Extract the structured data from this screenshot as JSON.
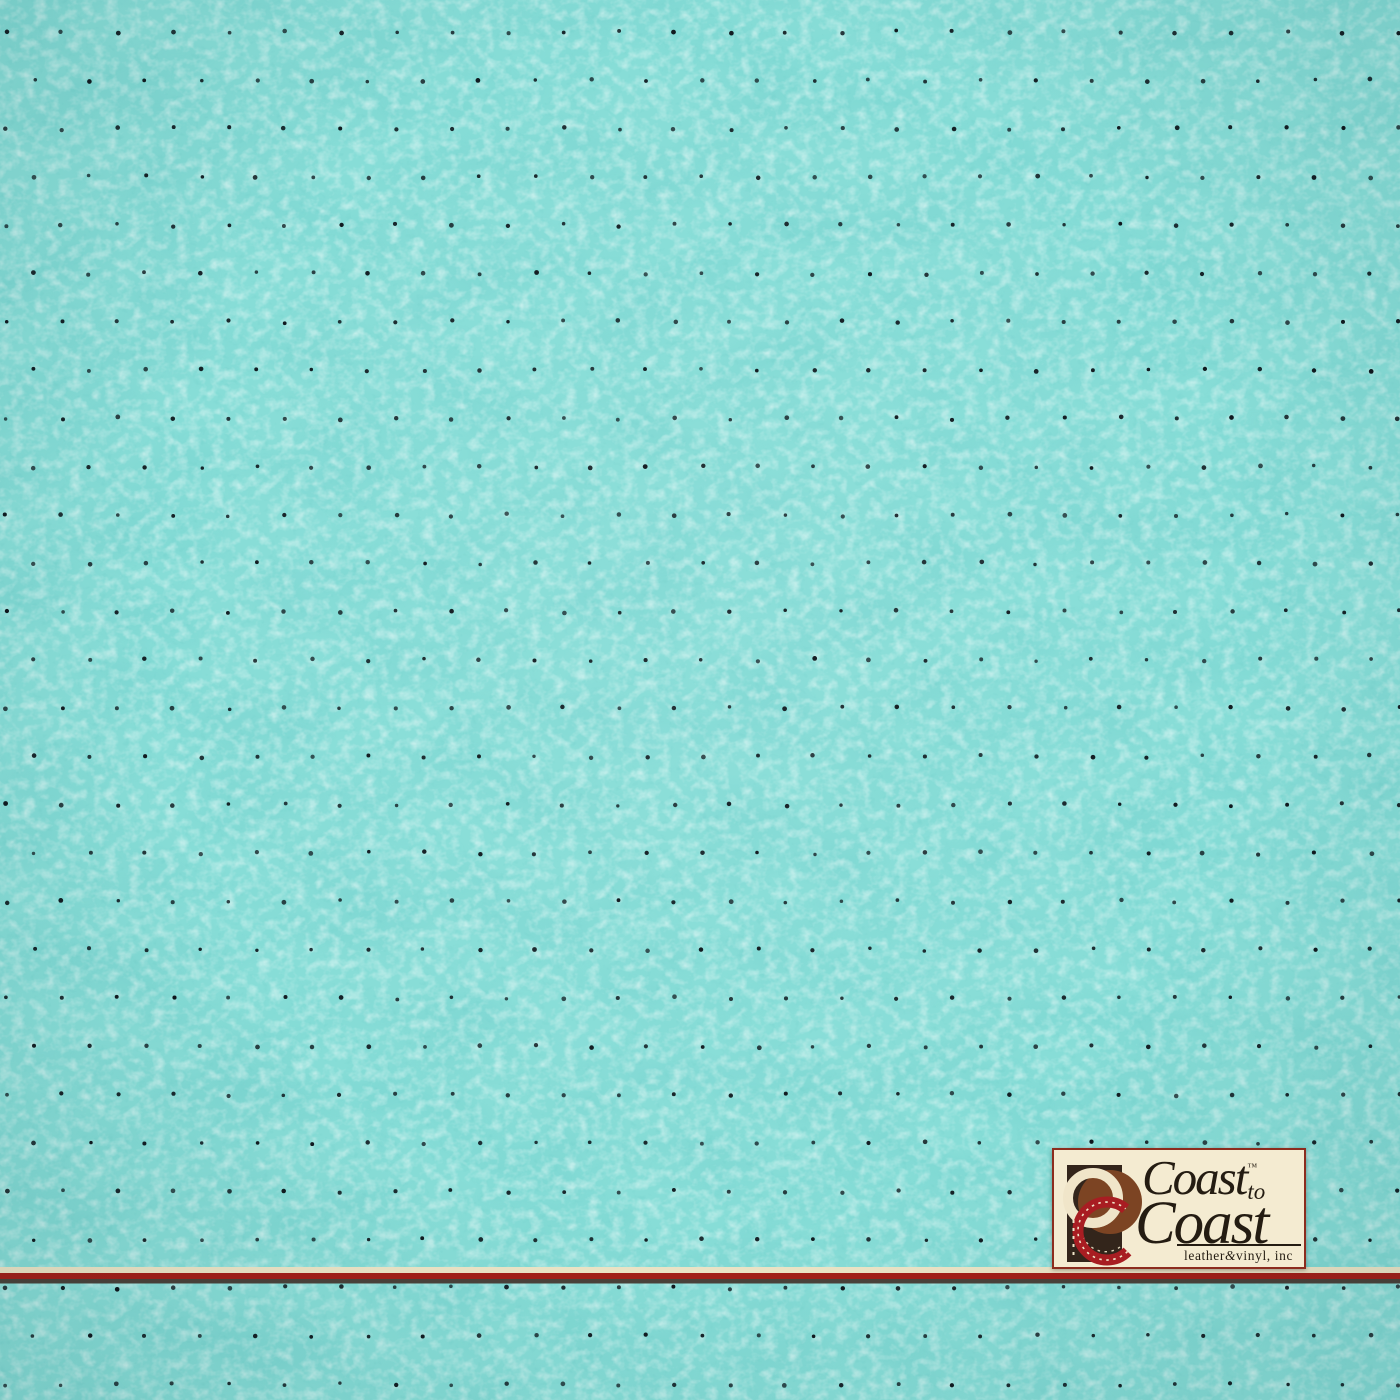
{
  "image": {
    "subject": "turquoise perforated leather vinyl upholstery swatch",
    "width": 1400,
    "height": 1400
  },
  "colors": {
    "fabric_base": "#87ddd7",
    "fabric_shade": "#2fa09b",
    "fabric_highlight": "#f2fffc",
    "dot": "#0e161c",
    "ink": "#241c12"
  },
  "texture": {
    "perforation": {
      "start_x": 6,
      "start_y": 32,
      "col_spacing": 55.7,
      "row_spacing": 48.3,
      "row_offset": 27.8,
      "rows": 29,
      "cols": 26,
      "dot_radius": 2,
      "jitter": 3
    }
  },
  "stripe": {
    "cream": "#ece4c6",
    "red": "#a31e18",
    "dark": "#4a423a"
  },
  "logo": {
    "bg": "#f4ebd1",
    "border": "#8c2c1e",
    "line1": "Coast",
    "trademark": "™",
    "line1_suffix": "to",
    "line2": "Coast",
    "tagline_1": "leather",
    "tagline_amp": "&",
    "tagline_2": "vinyl, inc",
    "emblem": {
      "rect": "#33251b",
      "sienna": "#7c4423",
      "cream": "#f0e5c9",
      "red": "#a81d22"
    }
  }
}
